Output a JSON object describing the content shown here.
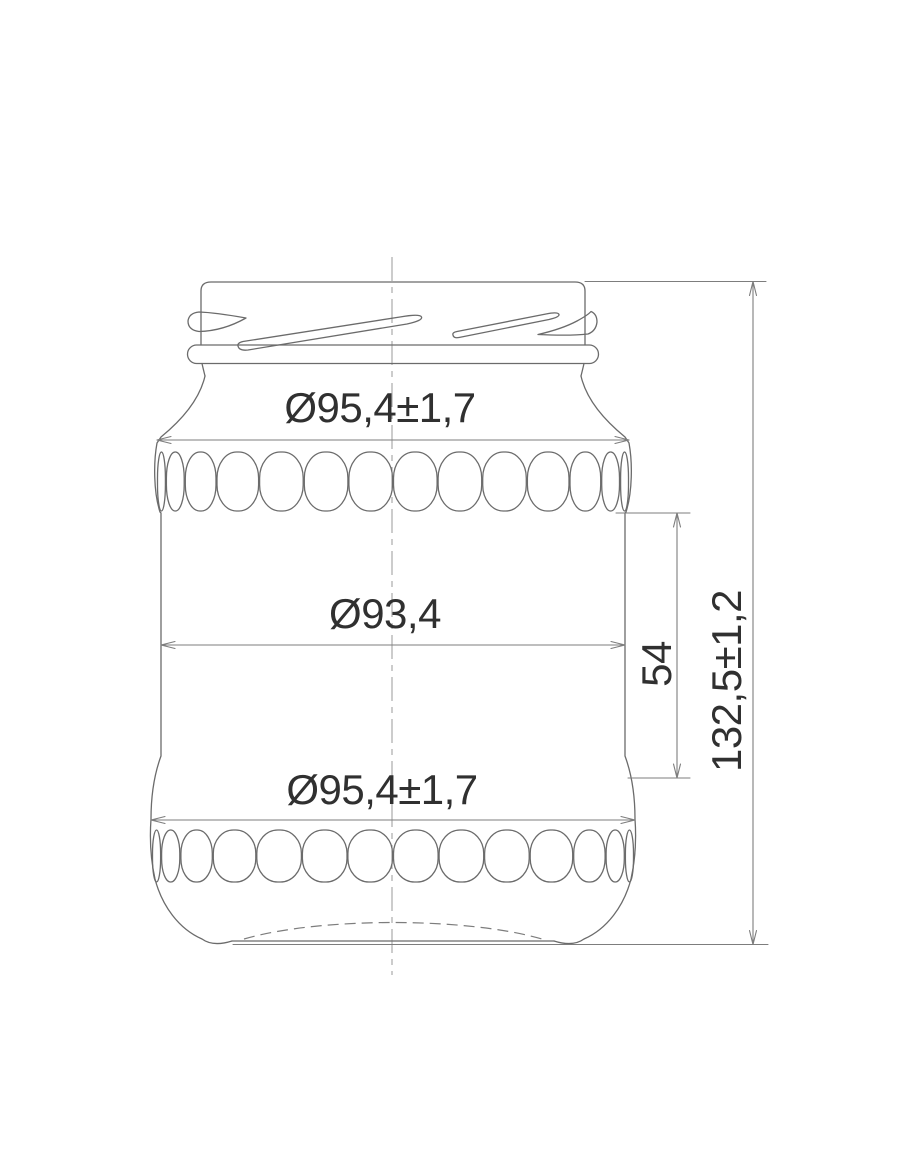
{
  "labels": {
    "top_diameter": "Ø95,4±1,7",
    "inner_diameter": "Ø93,4",
    "bottom_diameter": "Ø95,4±1,7",
    "panel_height": "54",
    "overall_height": "132,5±1,2"
  },
  "colors": {
    "outline": "#6b6b6b",
    "dimension_line": "#7d7d7d",
    "centerline": "#9a9a9a",
    "label_text": "#303030",
    "background": "#ffffff"
  }
}
